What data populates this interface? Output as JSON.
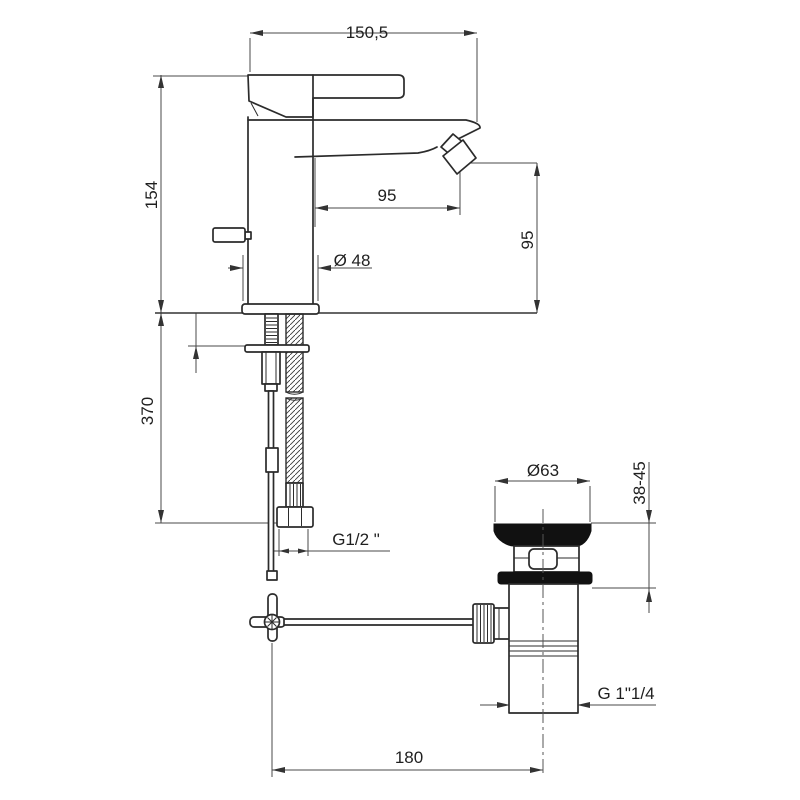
{
  "drawing": {
    "background_color": "#ffffff",
    "line_color": "#2b2b2b",
    "dimension_color": "#4a4a4a",
    "dimensions": {
      "spout_width_top": "150,5",
      "body_height": "154",
      "spout_reach": "95",
      "base_diameter": "Ø 48",
      "spout_height": "95",
      "under_counter_length": "370",
      "supply_thread": "G1/2 \"",
      "waste_flange_diameter": "Ø63",
      "mounting_thickness_range": "38-45",
      "waste_thread": "G 1\"1/4",
      "rod_to_waste_distance": "180"
    }
  }
}
